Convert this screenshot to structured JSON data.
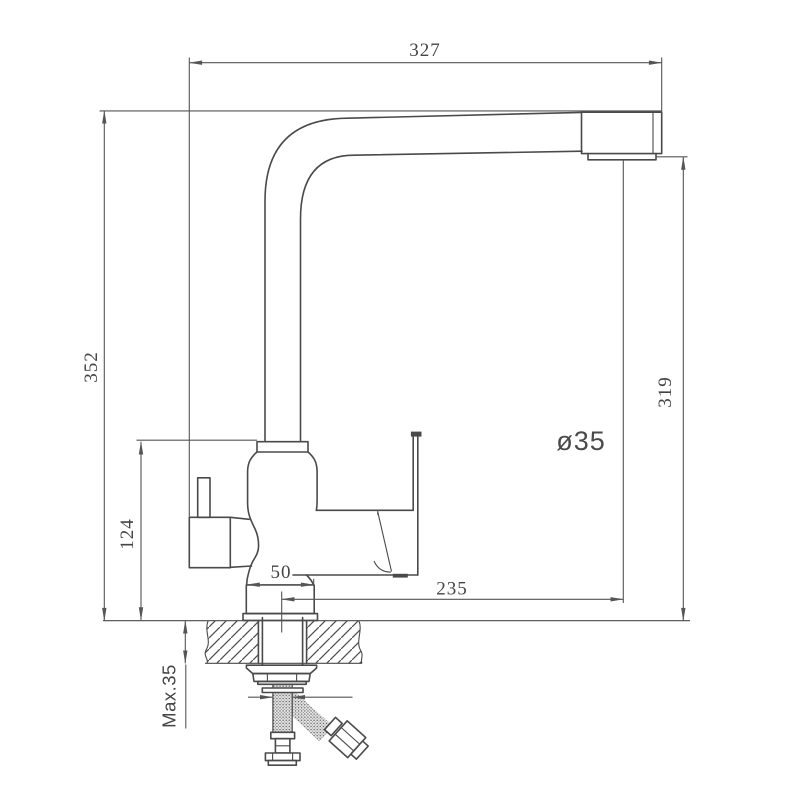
{
  "drawing": {
    "kind": "faucet-installation-dimension-drawing",
    "dimensions": {
      "spout_width_top": "327",
      "overall_height_left": "352",
      "spout_outlet_height_right": "319",
      "body_height": "124",
      "base_width": "50",
      "spout_reach": "235",
      "hole_diameter": "ø35",
      "countertop_thickness": "Max.35"
    },
    "colors": {
      "object_line": "#4a4a4a",
      "dimension_line": "#555555",
      "text": "#444444",
      "background": "#ffffff"
    }
  }
}
